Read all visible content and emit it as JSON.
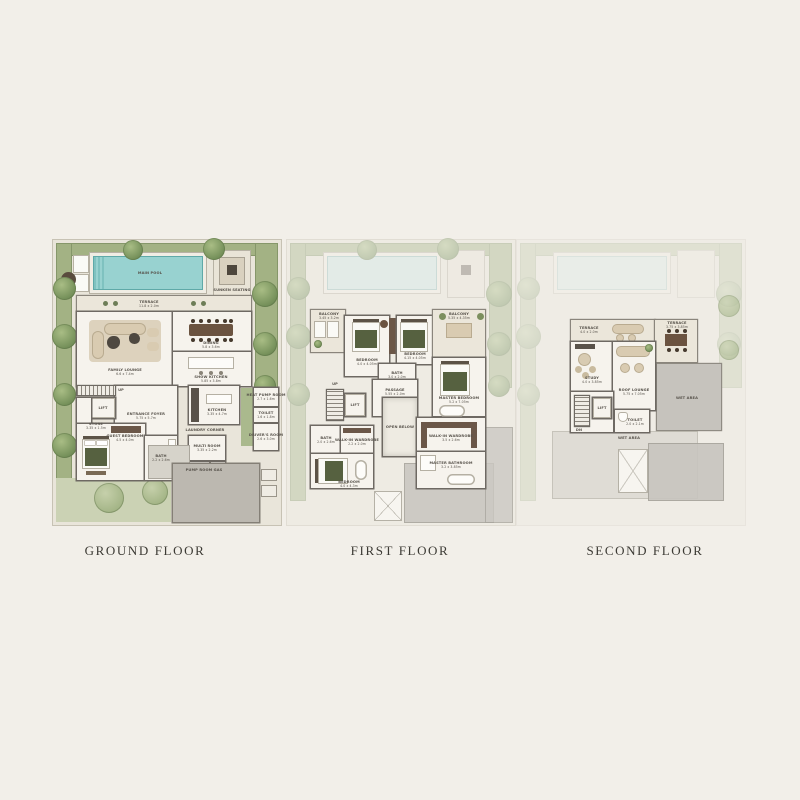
{
  "captions": {
    "ground": "GROUND FLOOR",
    "first": "FIRST FLOOR",
    "second": "SECOND FLOOR"
  },
  "ground": {
    "pool": "MAIN POOL",
    "sunken_seating": "SUNKEN SEATING",
    "terrace": {
      "label": "TERRACE",
      "dim": "11.8 x 2.0m"
    },
    "family_lounge": {
      "label": "FAMILY LOUNGE",
      "dim": "6.6 x 7.4m"
    },
    "dining": {
      "label": "DINING",
      "dim": "5.8 x 3.6m"
    },
    "show_kitchen": {
      "label": "SHOW KITCHEN",
      "dim": "5.85 x 3.8m"
    },
    "entrance_foyer": {
      "label": "ENTRANCE FOYER",
      "dim": "5.75 x 5.7m"
    },
    "lift": "LIFT",
    "up": "UP",
    "store": {
      "label": "STORE",
      "dim": "3.35 x 1.5m"
    },
    "guest_bedroom": {
      "label": "GUEST BEDROOM",
      "dim": "4.5 x 4.0m"
    },
    "bath": {
      "label": "BATH",
      "dim": "2.2 x 2.6m"
    },
    "kitchen": {
      "label": "KITCHEN",
      "dim": "3.35 x 4.7m"
    },
    "laundry_corner": "LAUNDRY CORNER",
    "multi_room": {
      "label": "MULTI ROOM",
      "dim": "3.35 x 2.2m"
    },
    "pump_room": "PUMP ROOM",
    "gas": "GAS",
    "heat_pump_room": {
      "label": "HEAT PUMP ROOM",
      "dim": "2.7 x 1.6m"
    },
    "toilet": {
      "label": "TOILET",
      "dim": "1.6 x 1.8m"
    },
    "drivers_room": {
      "label": "DRIVER'S ROOM",
      "dim": "2.6 x 3.0m"
    }
  },
  "first": {
    "balcony_left": {
      "label": "BALCONY",
      "dim": "3.45 x 3.2m"
    },
    "balcony_right": {
      "label": "BALCONY",
      "dim": "5.35 x 4.35m"
    },
    "bedroom_3": {
      "label": "BEDROOM",
      "dim": "4.0 x 4.05m"
    },
    "bedroom_2": {
      "label": "BEDROOM",
      "dim": "4.15 x 4.05m"
    },
    "bath_mid": {
      "label": "BATH",
      "dim": "3.0 x 2.0m"
    },
    "master_bedroom": {
      "label": "MASTER BEDROOM",
      "dim": "5.2 x 7.05m"
    },
    "walkin_wardrobe_right": {
      "label": "WALK-IN WARDROBE",
      "dim": "3.5 x 2.6m"
    },
    "master_bathroom": {
      "label": "MASTER BATHROOM",
      "dim": "3.2 x 3.85m"
    },
    "passage": {
      "label": "PASSAGE",
      "dim": "5.55 x 2.0m"
    },
    "open_below": "OPEN BELOW",
    "lift": "LIFT",
    "up": "UP",
    "bath_left": {
      "label": "BATH",
      "dim": "2.0 x 2.6m"
    },
    "walkin_wardrobe_left": {
      "label": "WALK-IN WARDROBE",
      "dim": "2.2 x 2.0m"
    },
    "bedroom_1": {
      "label": "BEDROOM",
      "dim": "4.0 x 4.3m"
    }
  },
  "second": {
    "terrace_left": {
      "label": "TERRACE",
      "dim": "4.0 x 2.0m"
    },
    "terrace_right": {
      "label": "TERRACE",
      "dim": "3.75 x 3.85m"
    },
    "study": {
      "label": "STUDY",
      "dim": "4.0 x 3.85m"
    },
    "roof_lounge": {
      "label": "ROOF LOUNGE",
      "dim": "5.75 x 7.05m"
    },
    "lift": "LIFT",
    "dn": "DN",
    "toilet": {
      "label": "TOILET",
      "dim": "2.0 x 2.1m"
    },
    "wet_area_right": "WET AREA",
    "wet_area_bottom": "WET AREA"
  }
}
